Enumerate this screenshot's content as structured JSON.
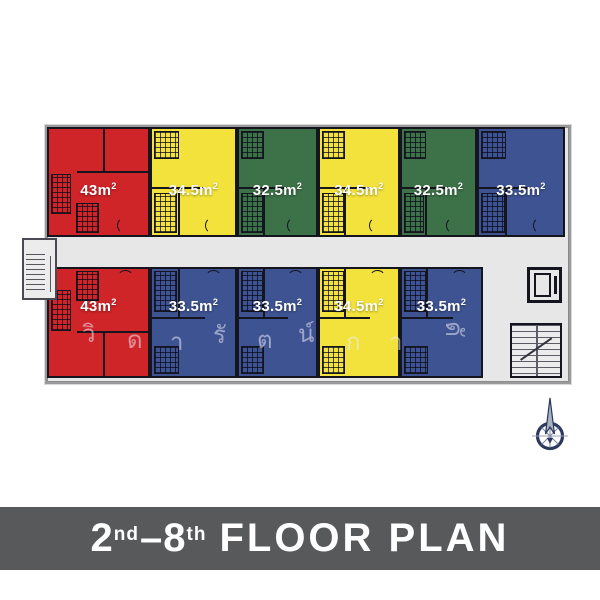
{
  "plan": {
    "top_units": [
      {
        "color_name": "red",
        "label": "43m",
        "sup": "2"
      },
      {
        "color_name": "yellow",
        "label": "34.5m",
        "sup": "2"
      },
      {
        "color_name": "green",
        "label": "32.5m",
        "sup": "2"
      },
      {
        "color_name": "yellow",
        "label": "34.5m",
        "sup": "2"
      },
      {
        "color_name": "green",
        "label": "32.5m",
        "sup": "2"
      },
      {
        "color_name": "blue",
        "label": "33.5m",
        "sup": "2"
      }
    ],
    "bottom_units": [
      {
        "color_name": "red",
        "label": "43m",
        "sup": "2"
      },
      {
        "color_name": "blue",
        "label": "33.5m",
        "sup": "2"
      },
      {
        "color_name": "blue",
        "label": "33.5m",
        "sup": "2"
      },
      {
        "color_name": "yellow",
        "label": "34.5m",
        "sup": "2"
      },
      {
        "color_name": "blue",
        "label": "33.5m",
        "sup": "2"
      }
    ],
    "watermark_letters": [
      "วิ",
      "ด",
      "า",
      "รั",
      "ต",
      "น์",
      "ก",
      "า",
      "ดั"
    ]
  },
  "banner": {
    "num1": "2",
    "sup1": "nd",
    "dash": "–",
    "num2": "8",
    "sup2": "th",
    "text": "FLOOR PLAN"
  },
  "icons": {
    "compass": "compass-north-arrow"
  },
  "colors": {
    "red": "#cf2428",
    "yellow": "#f3e23b",
    "green": "#3d7148",
    "blue": "#3e5392",
    "wall": "#15151f",
    "corridor": "#e7e7e7",
    "banner_bg": "#58595b",
    "banner_text": "#ffffff",
    "compass": "#2b3a5c"
  }
}
